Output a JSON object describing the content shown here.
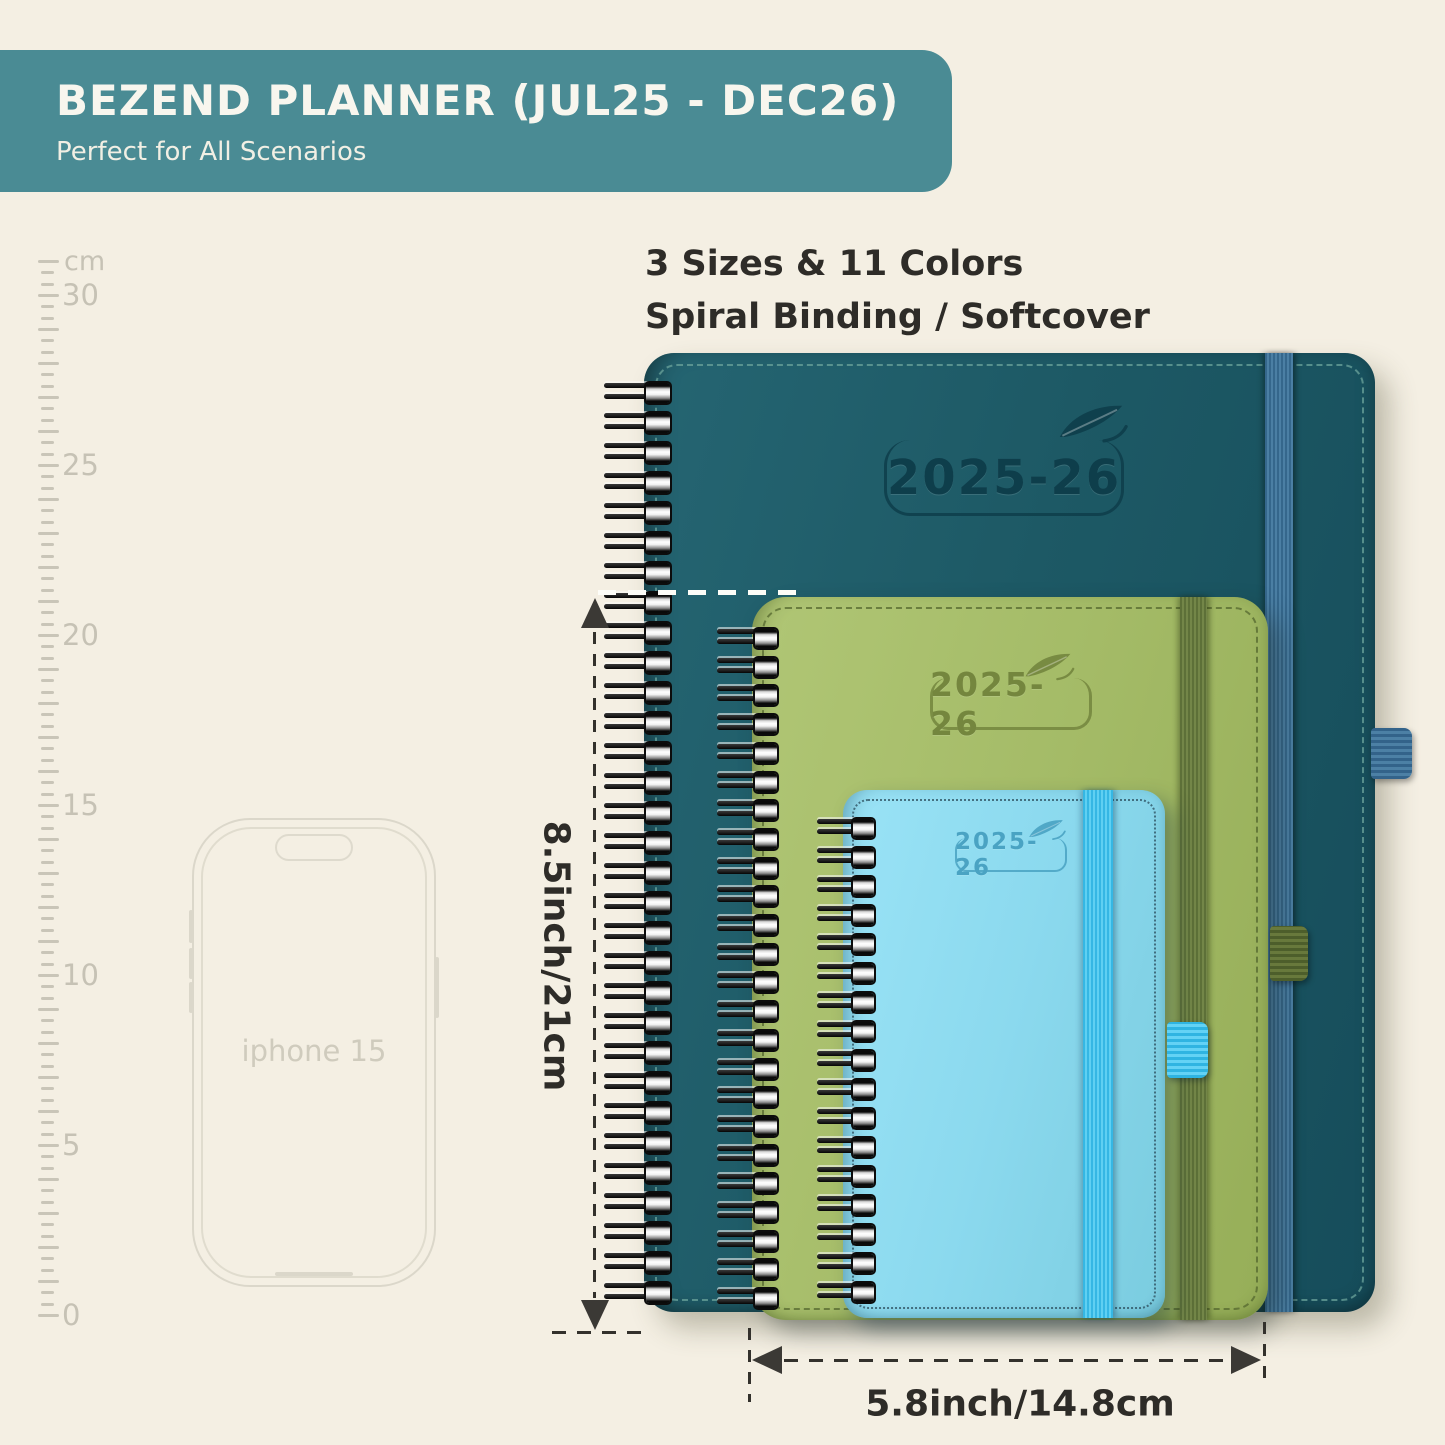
{
  "banner": {
    "title": "BEZEND PLANNER (JUL25 - DEC26)",
    "subtitle": "Perfect for All Scenarios",
    "background": "#4a8b94"
  },
  "highlights": {
    "line1": "3 Sizes & 11 Colors",
    "line2": "Spiral Binding / Softcover"
  },
  "ruler": {
    "unit": "cm",
    "max_cm": 31,
    "labels": [
      "30",
      "25",
      "20",
      "15",
      "10",
      "5",
      "0"
    ]
  },
  "phone": {
    "label": "iphone 15"
  },
  "planners": {
    "large": {
      "year": "2025-26",
      "cover_color": "#1d5965",
      "band_color": "#4b7fa4"
    },
    "medium": {
      "year": "2025-26",
      "cover_color": "#a4bb67",
      "band_color": "#68793c"
    },
    "small": {
      "year": "2025-26",
      "cover_color": "#8bd9ee",
      "band_color": "#4cc4ec"
    }
  },
  "measurements": {
    "height_label": "8.5inch/21cm",
    "width_label": "5.8inch/14.8cm"
  },
  "colors": {
    "background": "#f4efe3",
    "annotation_dark": "#33312c",
    "ruler_gray": "#c9c5b8"
  }
}
